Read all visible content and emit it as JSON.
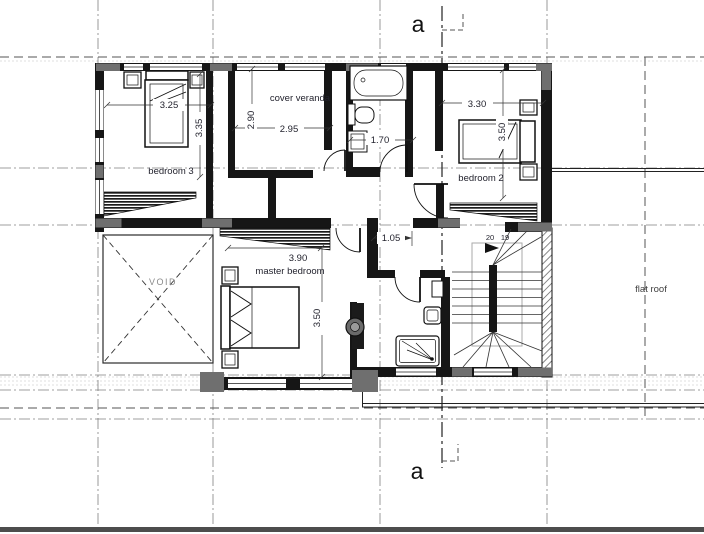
{
  "section_markers": {
    "top": "a",
    "bottom": "a"
  },
  "room_labels": {
    "bedroom3": "bedroom 3",
    "cover_veranda": "cover veranda",
    "bedroom2": "bedroom 2",
    "master_bedroom": "master bedroom",
    "void": "VOID",
    "flat_roof": "flat roof"
  },
  "dimensions": {
    "bedroom3_width": "3.25",
    "bedroom3_height": "3.35",
    "veranda_height": "2.90",
    "veranda_width": "2.95",
    "bathroom_width": "1.70",
    "bedroom2_width": "3.30",
    "bedroom2_height": "3.50",
    "master_width": "3.90",
    "master_height": "3.50",
    "hall_width": "1.05"
  },
  "stairs": {
    "step_upper": "20",
    "step_lower": "19"
  },
  "colors": {
    "wall": "#161616",
    "poche": "#6f6f6f",
    "grid_line": "#808080",
    "dashed_line": "#555555",
    "text": "#23232e",
    "void_text": "#8a8a8a",
    "bottom_bar": "#4d4d4d",
    "background": "#ffffff"
  }
}
